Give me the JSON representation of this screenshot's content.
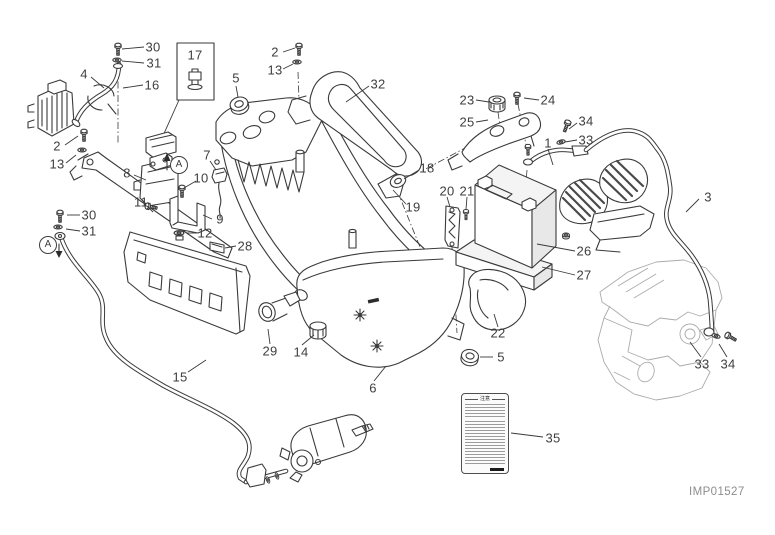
{
  "diagram": {
    "watermark": "IMP01527",
    "warning_label": {
      "title": "注意"
    },
    "view_markers": [
      {
        "label": "A",
        "x": 179,
        "y": 165,
        "arrow": "up"
      },
      {
        "label": "A",
        "x": 48,
        "y": 245,
        "arrow": "down"
      }
    ],
    "callouts": [
      {
        "label": "30",
        "x": 153,
        "y": 47
      },
      {
        "label": "31",
        "x": 154,
        "y": 63
      },
      {
        "label": "4",
        "x": 84,
        "y": 74
      },
      {
        "label": "16",
        "x": 152,
        "y": 85
      },
      {
        "label": "17",
        "x": 195,
        "y": 55
      },
      {
        "label": "5",
        "x": 236,
        "y": 78
      },
      {
        "label": "2",
        "x": 275,
        "y": 52
      },
      {
        "label": "13",
        "x": 275,
        "y": 70
      },
      {
        "label": "32",
        "x": 378,
        "y": 84
      },
      {
        "label": "23",
        "x": 467,
        "y": 100
      },
      {
        "label": "24",
        "x": 548,
        "y": 100
      },
      {
        "label": "25",
        "x": 467,
        "y": 122
      },
      {
        "label": "34",
        "x": 586,
        "y": 121
      },
      {
        "label": "33",
        "x": 586,
        "y": 140
      },
      {
        "label": "1",
        "x": 548,
        "y": 143
      },
      {
        "label": "3",
        "x": 708,
        "y": 197
      },
      {
        "label": "2",
        "x": 57,
        "y": 146
      },
      {
        "label": "13",
        "x": 57,
        "y": 164
      },
      {
        "label": "7",
        "x": 207,
        "y": 155
      },
      {
        "label": "10",
        "x": 201,
        "y": 178
      },
      {
        "label": "8",
        "x": 127,
        "y": 173
      },
      {
        "label": "11",
        "x": 141,
        "y": 202
      },
      {
        "label": "9",
        "x": 220,
        "y": 219
      },
      {
        "label": "12",
        "x": 205,
        "y": 233
      },
      {
        "label": "28",
        "x": 245,
        "y": 246
      },
      {
        "label": "30",
        "x": 89,
        "y": 215
      },
      {
        "label": "31",
        "x": 89,
        "y": 231
      },
      {
        "label": "18",
        "x": 427,
        "y": 168
      },
      {
        "label": "19",
        "x": 413,
        "y": 207
      },
      {
        "label": "20",
        "x": 447,
        "y": 191
      },
      {
        "label": "21",
        "x": 467,
        "y": 191
      },
      {
        "label": "26",
        "x": 584,
        "y": 251
      },
      {
        "label": "27",
        "x": 584,
        "y": 275
      },
      {
        "label": "22",
        "x": 498,
        "y": 333
      },
      {
        "label": "5",
        "x": 501,
        "y": 357
      },
      {
        "label": "29",
        "x": 270,
        "y": 351
      },
      {
        "label": "14",
        "x": 301,
        "y": 352
      },
      {
        "label": "6",
        "x": 373,
        "y": 388
      },
      {
        "label": "15",
        "x": 180,
        "y": 377
      },
      {
        "label": "35",
        "x": 553,
        "y": 438
      },
      {
        "label": "33",
        "x": 702,
        "y": 364
      },
      {
        "label": "34",
        "x": 728,
        "y": 364
      }
    ],
    "colors": {
      "background": "#ffffff",
      "line_art": "#3a3a3a",
      "engine_sketch": "#ababab",
      "callout_text": "#3e3e3e",
      "watermark_text": "#8d8d8d"
    }
  }
}
